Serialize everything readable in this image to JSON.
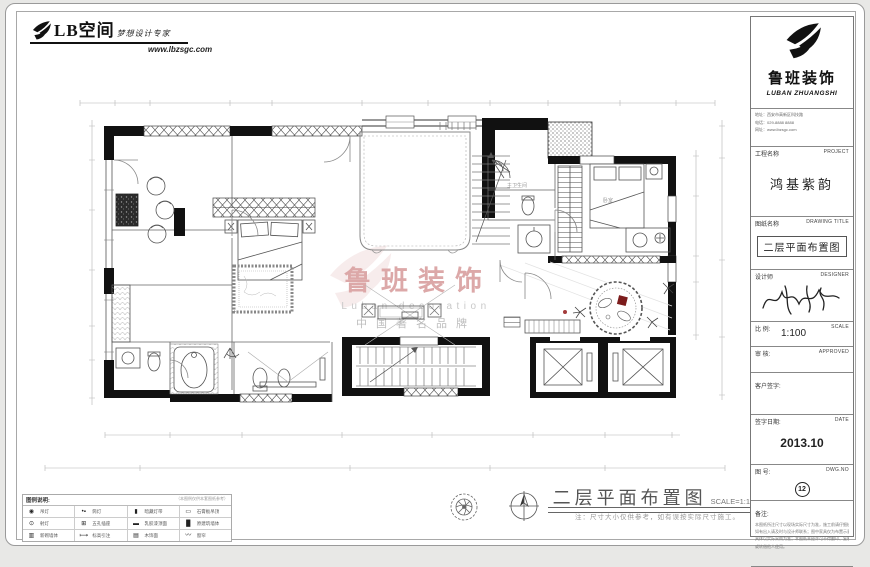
{
  "header": {
    "brand": "LB空间",
    "tagline": "梦想设计专家",
    "website": "www.lbzsgc.com"
  },
  "watermark": {
    "brand": "鲁班装饰",
    "sub": "Luban decoration",
    "tagline": "中国著名品牌",
    "accent_color": "#dca8a8"
  },
  "plan_labels": {
    "bath": "主卫生间",
    "bedroom": "卧室"
  },
  "footer": {
    "title": "二层平面布置图",
    "scale": "SCALE=1:100",
    "note": "注：尺寸大小仅供参考，如有误按实际尺寸施工。"
  },
  "legend": {
    "header": "图例说明:",
    "header_note": "（本图例仅供本套图纸参考）",
    "rows": [
      [
        {
          "sym": "◉",
          "label": "吊灯"
        },
        {
          "sym": "•▪",
          "label": "筒灯"
        },
        {
          "sym": "▮",
          "label": "暗藏灯带"
        },
        {
          "sym": "▭",
          "label": "石膏板吊顶"
        }
      ],
      [
        {
          "sym": "⊙",
          "label": "射灯"
        },
        {
          "sym": "⊞",
          "label": "五孔插座"
        },
        {
          "sym": "▬",
          "label": "乳胶漆顶面"
        },
        {
          "sym": "█",
          "label": "原建筑墙体"
        }
      ],
      [
        {
          "sym": "▥",
          "label": "新砌墙体"
        },
        {
          "sym": "⟼",
          "label": "标高引注"
        },
        {
          "sym": "▤",
          "label": "木饰面"
        },
        {
          "sym": "〰",
          "label": "窗帘"
        }
      ]
    ]
  },
  "title_block": {
    "brand": "鲁班装饰",
    "brand_en": "LUBAN ZHUANGSHI",
    "info_lines": [
      "地址：西安市高新区科技路",
      "电话：029-8888 8888",
      "网址：www.lbzsgc.com"
    ],
    "project_label": "工程名称",
    "project_en": "PROJECT",
    "project_name": "鸿基紫韵",
    "drawing_label": "图纸名称",
    "drawing_en": "DRAWING TITLE",
    "drawing_title": "二层平面布置图",
    "designer_label": "设计师",
    "designer_en": "DESIGNER",
    "scale_label": "比 例:",
    "scale_value": "1:100",
    "scale_en": "SCALE",
    "approve_label": "审 核:",
    "approve_en": "APPROVED",
    "client_label": "客户签字:",
    "date_label": "签字日期:",
    "date_en": "DATE",
    "date_value": "2013.10",
    "no_label": "图 号:",
    "no_en": "DWG.NO",
    "no_value": "12",
    "remark_label": "备注:",
    "remark_lines": [
      "本图纸所注尺寸以现场实际尺寸为准，施工前请仔细核对，",
      "如有出入请及时与设计师联系；图中家具仅为布置示意，",
      "具体以实际采购为准；本图纸未经许可不得翻印、复制",
      "或转借他人使用。"
    ]
  }
}
